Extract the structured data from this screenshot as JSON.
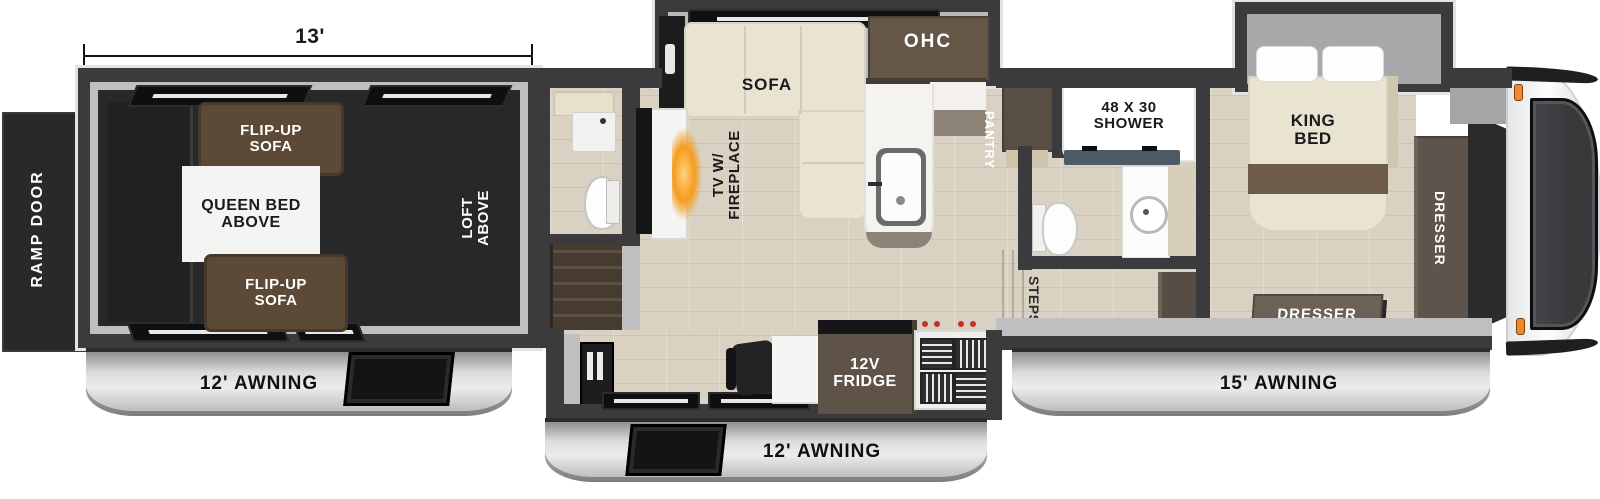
{
  "plan": {
    "dimension": "13'",
    "garage": {
      "ramp_door": "RAMP DOOR",
      "flip_up_sofa_top": "FLIP-UP\nSOFA",
      "queen_bed": "QUEEN BED\nABOVE",
      "flip_up_sofa_bottom": "FLIP-UP\nSOFA",
      "loft": "LOFT\nABOVE",
      "awning": "12' AWNING"
    },
    "living_kitchen": {
      "sofa": "SOFA",
      "ohc": "OHC",
      "tv_fireplace": "TV W/\nFIREPLACE",
      "pantry": "PANTRY",
      "fridge": "12V\nFRIDGE",
      "awning": "12' AWNING"
    },
    "bathroom": {
      "shower": "48 X 30\nSHOWER",
      "steps": "STEPS"
    },
    "bedroom": {
      "king_bed": "KING\nBED",
      "dresser_wardrobe": "DRESSER",
      "dresser_front": "DRESSER",
      "awning": "15' AWNING"
    },
    "colors": {
      "wall": "#3b3b3d",
      "garage_floor": "#28282a",
      "wood_floor": "#d9d2c2",
      "sofa_cream": "#e9e4d2",
      "sofa_brown": "#5c4936",
      "cabinet_wood": "#5f5348",
      "awning_silver": "#d9d9db",
      "flame_orange": "#f59b1f",
      "marker_light": "#f08a28"
    }
  }
}
